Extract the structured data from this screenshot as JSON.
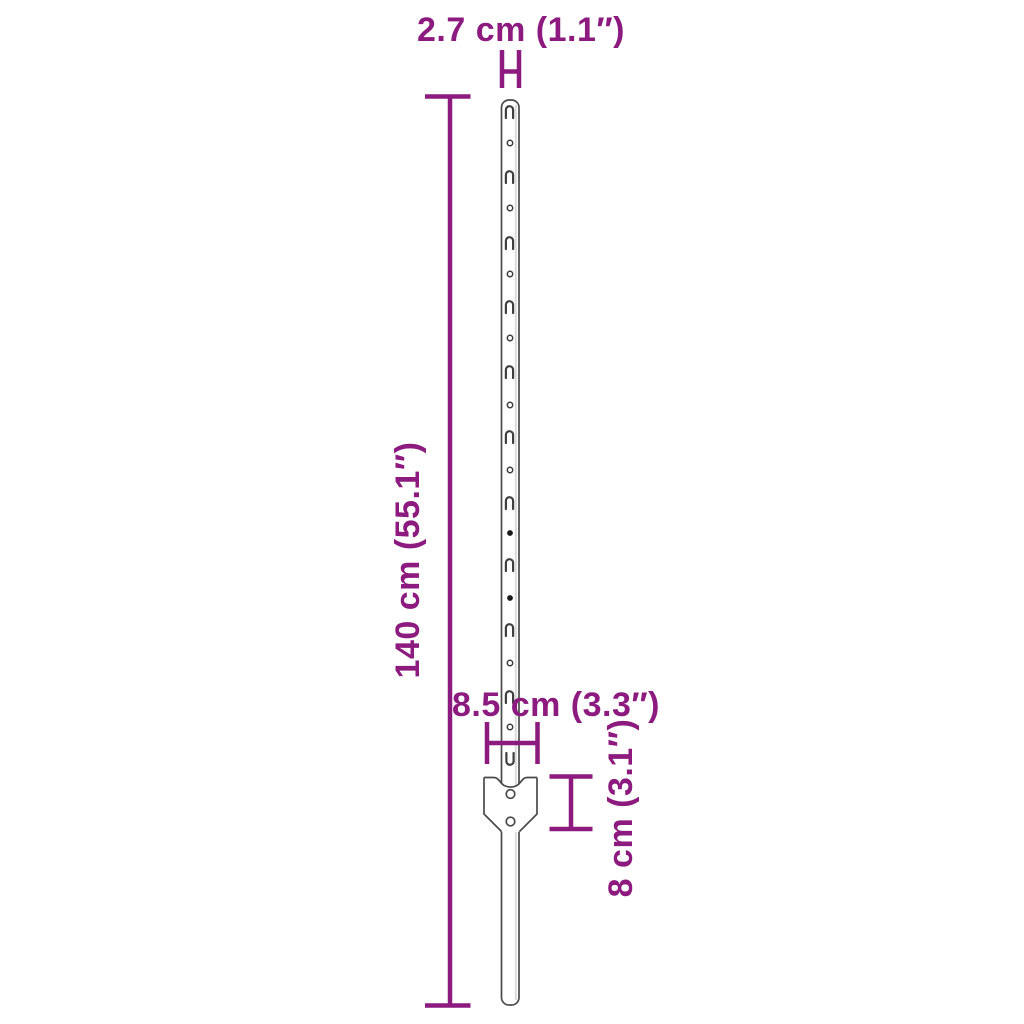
{
  "page": {
    "background_color": "#ffffff"
  },
  "diagram": {
    "kind": "product-dimension-diagram",
    "subject": "slotted metal fence post (U-post) with anchor plate",
    "accent_color": "#8C1A7F",
    "outline_color": "#4A4A4A",
    "labels": {
      "post_width": "2.7 cm (1.1″)",
      "post_height": "140 cm (55.1″)",
      "plate_width": "8.5 cm (3.3″)",
      "plate_height": "8 cm (3.1″)"
    },
    "dimensions": [
      {
        "name": "post width",
        "cm": 2.7,
        "inch": 1.1
      },
      {
        "name": "post height",
        "cm": 140,
        "inch": 55.1
      },
      {
        "name": "anchor plate width",
        "cm": 8.5,
        "inch": 3.3
      },
      {
        "name": "anchor plate height",
        "cm": 8,
        "inch": 3.1
      }
    ]
  }
}
